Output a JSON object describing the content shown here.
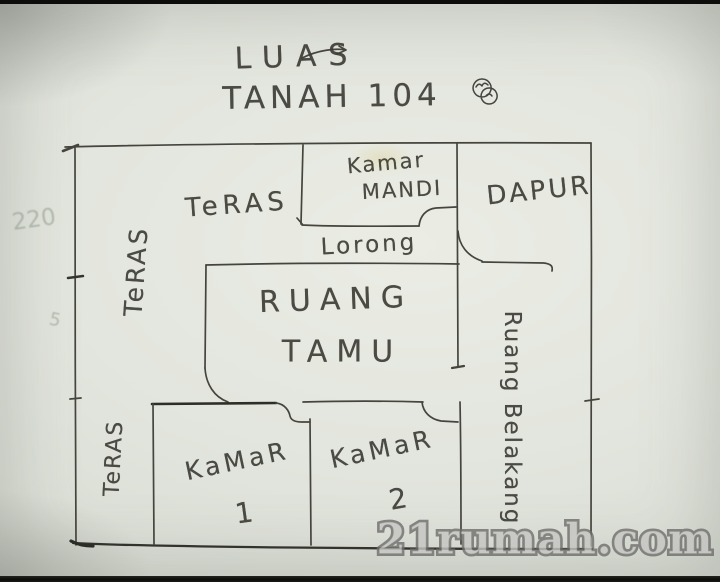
{
  "title": {
    "line1": "LUAS",
    "line2": "TANAH 104"
  },
  "rooms": {
    "teras_top": "TeRAS",
    "teras_left": "TeRAS",
    "teras_bottom": "TeRAS",
    "kamar_mandi_line1": "Kamar",
    "kamar_mandi_line2": "MANDI",
    "dapur": "DAPUR",
    "lorong": "Lorong",
    "ruang_tamu_line1": "RUANG",
    "ruang_tamu_line2": "TAMU",
    "kamar1_line1": "KaMaR",
    "kamar1_line2": "1",
    "kamar2_line1": "KaMaR",
    "kamar2_line2": "2",
    "ruang_belakang": "Ruang Belakang"
  },
  "annotations": {
    "left_dim_top": "220",
    "left_dim_mid": "5"
  },
  "watermark": {
    "text": "21rumah.com"
  },
  "colors": {
    "ink": "#45453e",
    "ink_dark": "#2f2f2a",
    "paper": "#e2e5dd",
    "watermark_fill": "#c6c6c3",
    "watermark_outline": "#6e6e6c"
  }
}
